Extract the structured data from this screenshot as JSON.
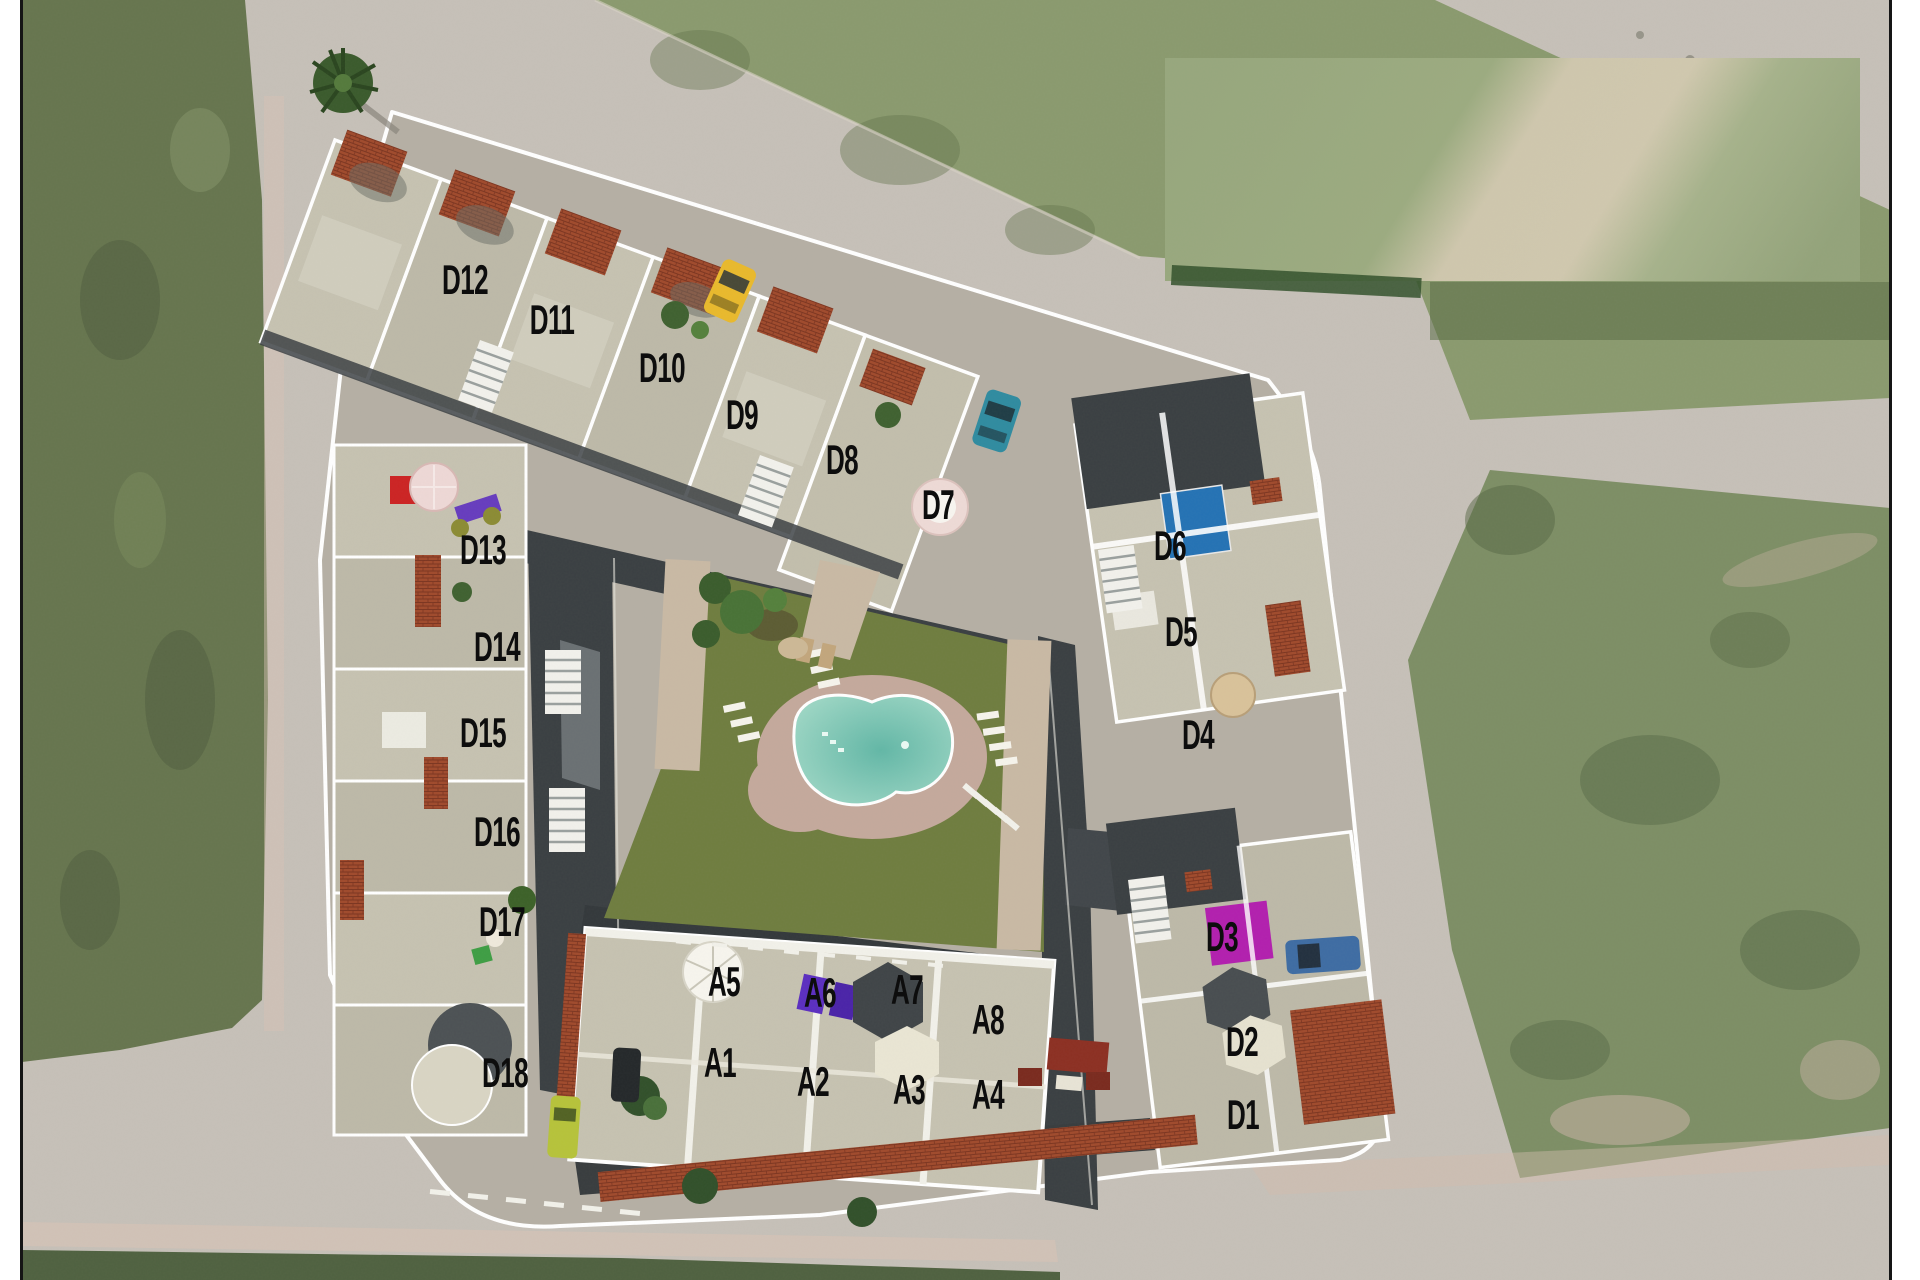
{
  "plan": {
    "units": [
      {
        "label": "D1",
        "x": 1243,
        "y": 1115
      },
      {
        "label": "D2",
        "x": 1242,
        "y": 1042
      },
      {
        "label": "D3",
        "x": 1222,
        "y": 937
      },
      {
        "label": "D4",
        "x": 1198,
        "y": 735
      },
      {
        "label": "D5",
        "x": 1181,
        "y": 632
      },
      {
        "label": "D6",
        "x": 1170,
        "y": 546
      },
      {
        "label": "D7",
        "x": 938,
        "y": 505
      },
      {
        "label": "D8",
        "x": 842,
        "y": 460
      },
      {
        "label": "D9",
        "x": 742,
        "y": 415
      },
      {
        "label": "D10",
        "x": 662,
        "y": 368
      },
      {
        "label": "D11",
        "x": 552,
        "y": 320
      },
      {
        "label": "D12",
        "x": 465,
        "y": 280
      },
      {
        "label": "D13",
        "x": 483,
        "y": 550
      },
      {
        "label": "D14",
        "x": 497,
        "y": 647
      },
      {
        "label": "D15",
        "x": 483,
        "y": 733
      },
      {
        "label": "D16",
        "x": 497,
        "y": 832
      },
      {
        "label": "D17",
        "x": 502,
        "y": 922
      },
      {
        "label": "D18",
        "x": 505,
        "y": 1073
      },
      {
        "label": "A1",
        "x": 720,
        "y": 1063
      },
      {
        "label": "A2",
        "x": 813,
        "y": 1082
      },
      {
        "label": "A3",
        "x": 909,
        "y": 1090
      },
      {
        "label": "A4",
        "x": 988,
        "y": 1095
      },
      {
        "label": "A5",
        "x": 724,
        "y": 982
      },
      {
        "label": "A6",
        "x": 820,
        "y": 993
      },
      {
        "label": "A7",
        "x": 907,
        "y": 990
      },
      {
        "label": "A8",
        "x": 988,
        "y": 1020
      }
    ],
    "label_style": {
      "color": "#0d0d0d",
      "font_size": 42
    }
  },
  "colors": {
    "road": "#c6c0b8",
    "field_left": "#66754e",
    "field_top": "#8a9a6e",
    "field_right": "#7d8e65",
    "field_bottom": "#4f6140",
    "blur_patch_green": "#9cab80",
    "blur_patch_band": "#cfc7ad",
    "parcel_ground": "#b5afa4",
    "terrace": "#c6c2b1",
    "terrace_alt": "#bdb9a8",
    "wall_white": "#f5f4ef",
    "garage_dark": "#3a3f42",
    "brick": "#a04a2c",
    "lawn": "#6f7d3f",
    "pool_deck": "#c4a99c",
    "pool_water_light": "#a9ddcb",
    "pool_water_deep": "#62b7a6",
    "d6_pool": "#2472b4",
    "d3_square": "#b21fae",
    "car_yellow": "#e9b92c",
    "car_teal": "#2f8ba0",
    "car_blue": "#3e6ca3",
    "car_lime": "#b6c33a",
    "umbrella_red": "#cc2323",
    "umbrella_pink": "#eed8d6",
    "lounger_violet": "#5b2ec0",
    "furniture_red": "#8c2f22",
    "sidewalk_pink": "#d8c3b6",
    "frame_border": "#151515"
  }
}
